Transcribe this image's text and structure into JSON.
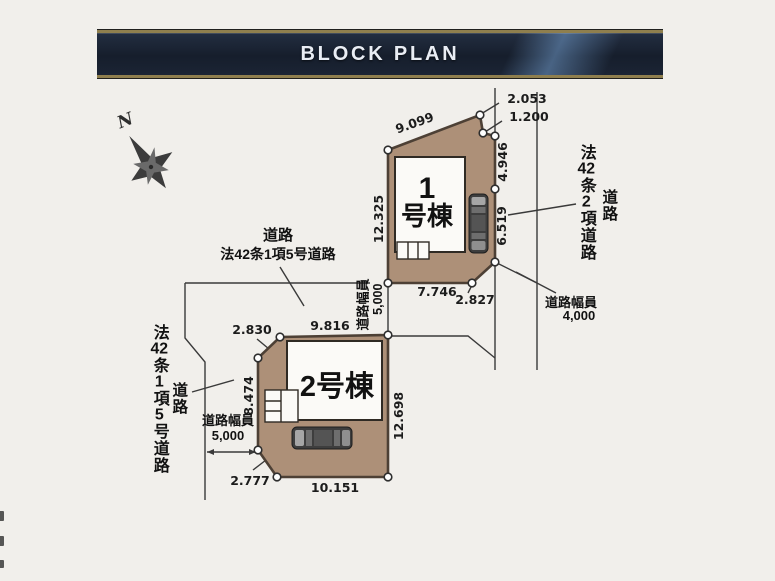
{
  "header": {
    "title": "BLOCK PLAN"
  },
  "compass": {
    "north": "N"
  },
  "buildings": {
    "b1": {
      "line1": "1",
      "line2": "号棟"
    },
    "b2": {
      "label": "2号棟"
    }
  },
  "dims": {
    "lot1": {
      "top": "9.099",
      "cut_a": "2.053",
      "cut_b": "1.200",
      "right_upper": "4.946",
      "right_lower": "6.519",
      "left": "12.325",
      "bottom": "7.746",
      "corner": "2.827"
    },
    "lot2": {
      "cut_top": "2.830",
      "top": "9.816",
      "left": "8.474",
      "right": "12.698",
      "cut_bottom": "2.777",
      "bottom": "10.151"
    }
  },
  "roads": {
    "mid": {
      "road": "道路",
      "law": "法42条1項5号道路"
    },
    "mid_width": {
      "label": "道路幅員",
      "value": "5,000"
    },
    "right": {
      "road": "道路",
      "law": "法42条2項道路"
    },
    "right_width": {
      "label": "道路幅員",
      "value": "4,000"
    },
    "left": {
      "road": "道路",
      "law": "法42条1項5号道路"
    },
    "left_width": {
      "label": "道路幅員",
      "value": "5,000"
    }
  },
  "colors": {
    "lot_fill": "#ad9078",
    "lot_border": "#4d4035",
    "header_navy": "#1b2434",
    "header_gold": "#8f7f4e"
  }
}
